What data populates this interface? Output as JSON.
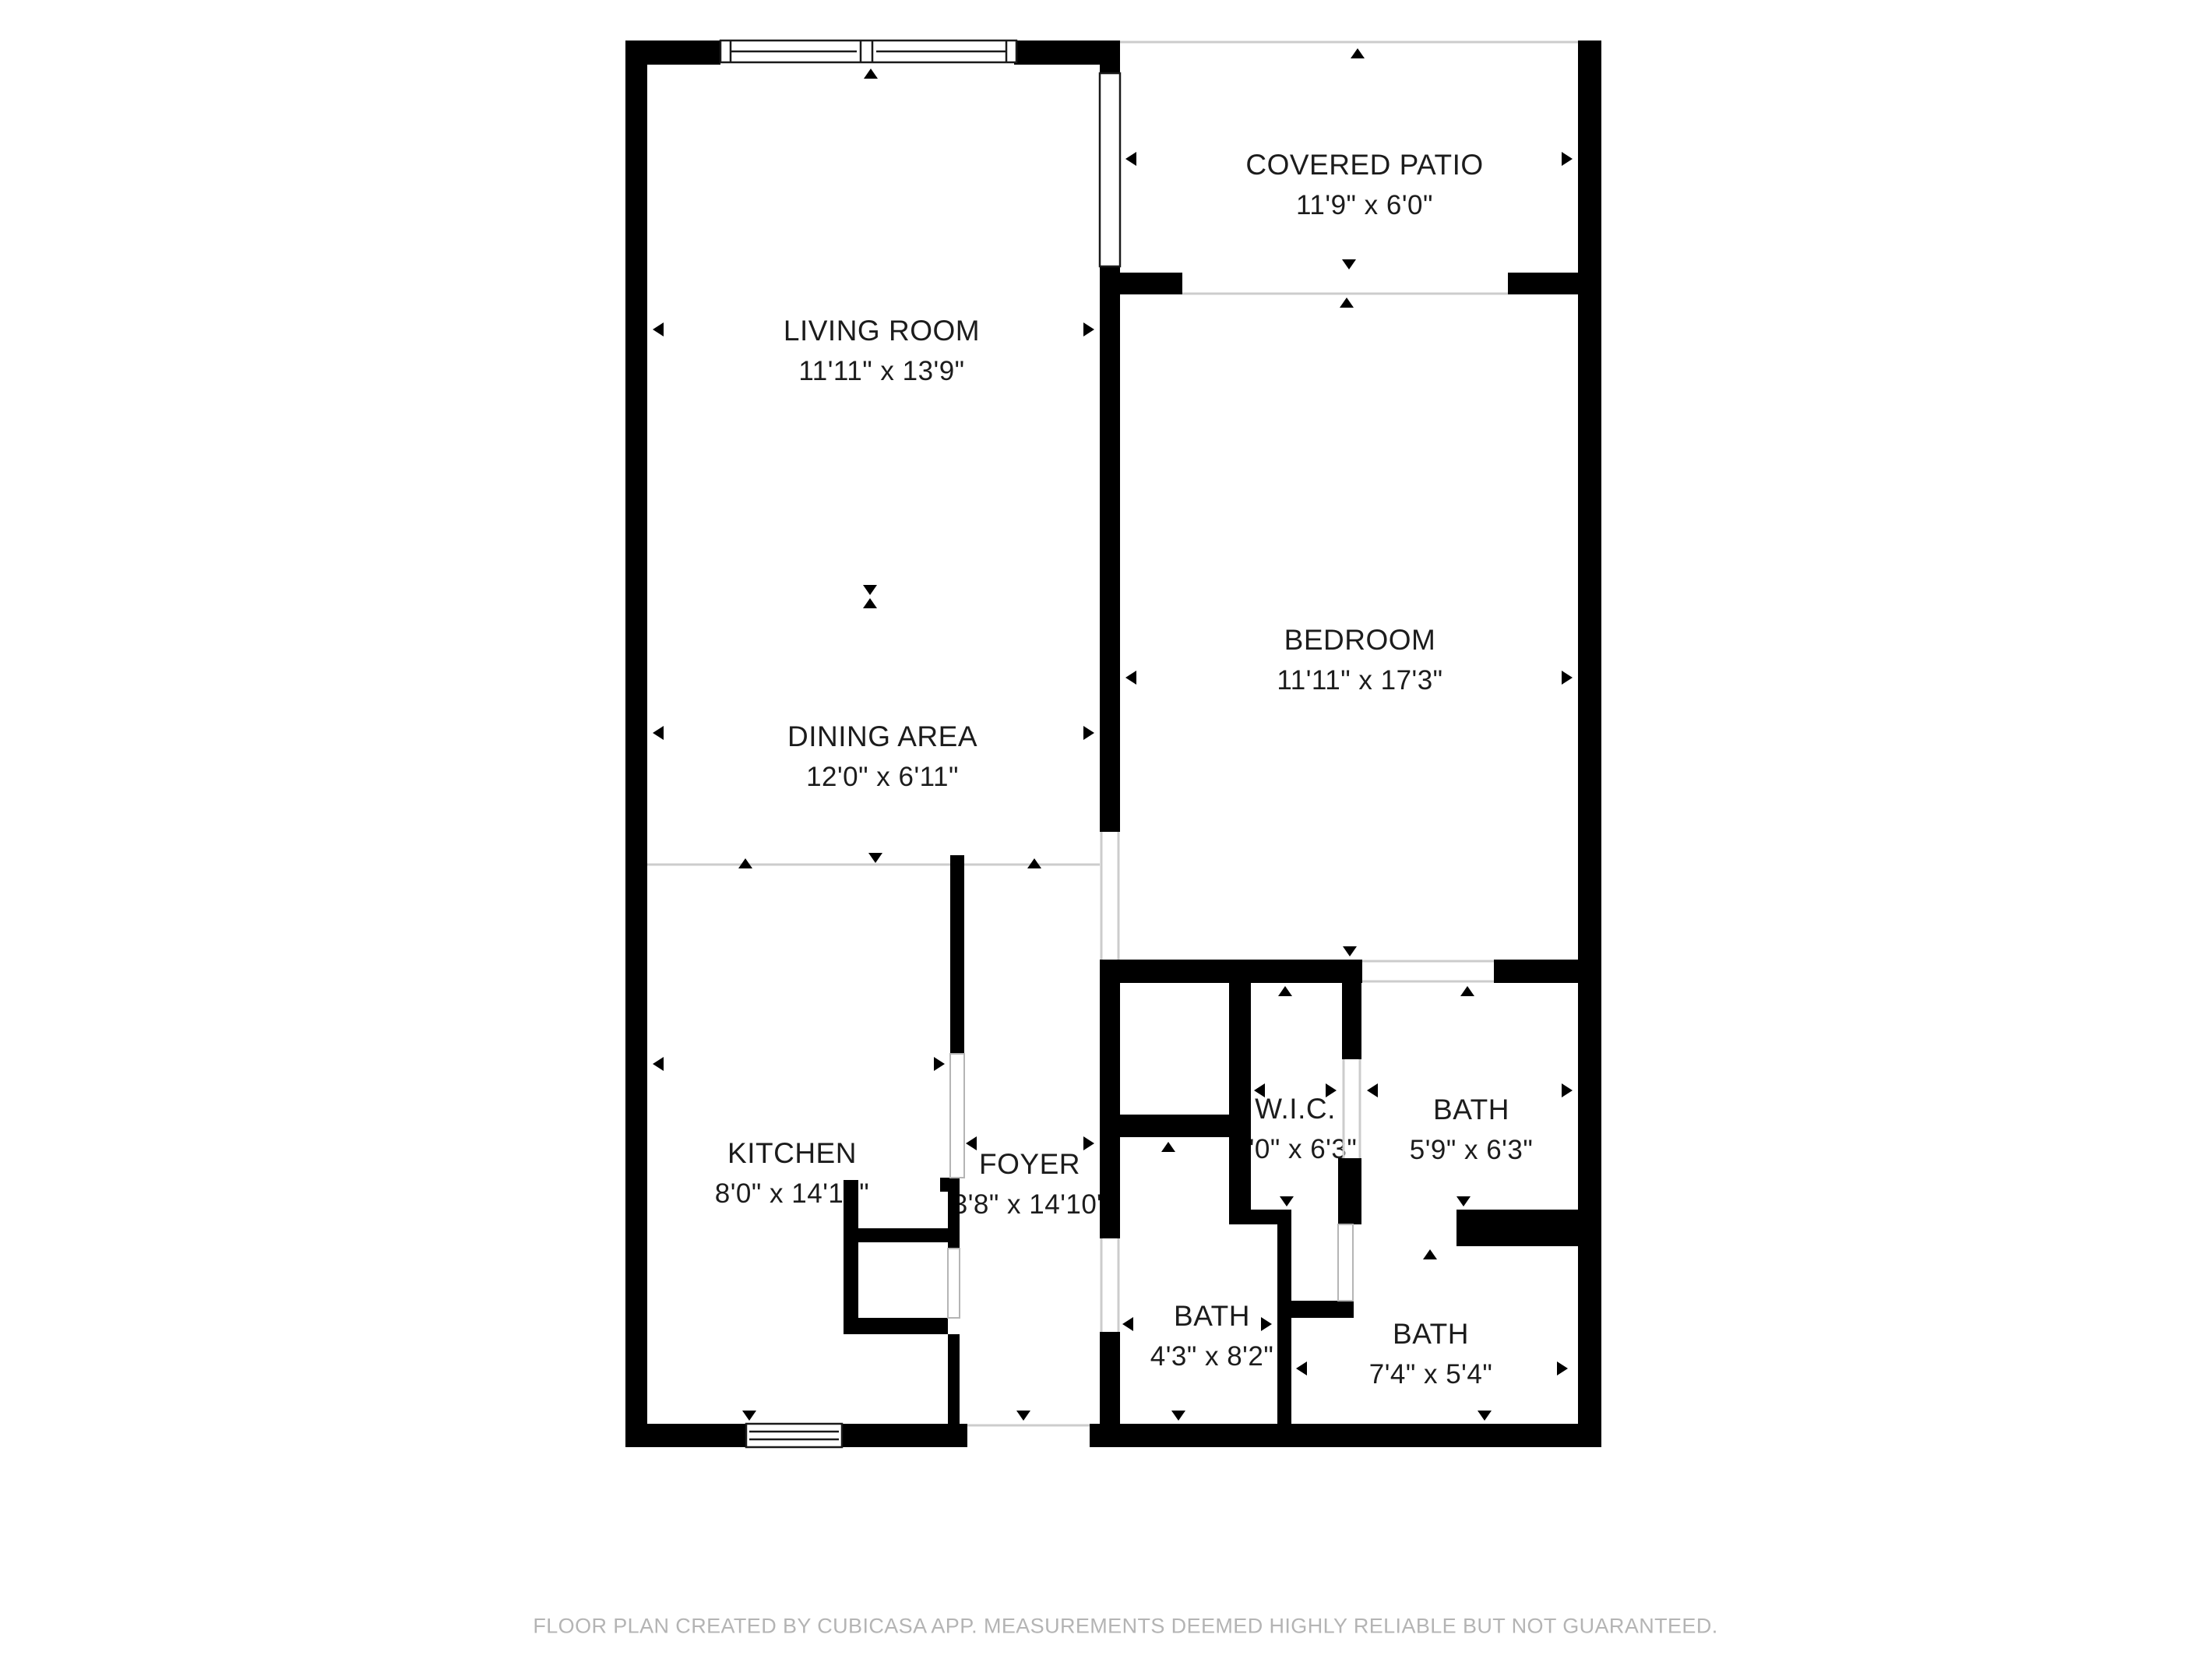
{
  "floor_plan": {
    "rooms": [
      {
        "id": "covered-patio",
        "name": "COVERED PATIO",
        "dimensions": "11'9\" x 6'0\""
      },
      {
        "id": "living-room",
        "name": "LIVING ROOM",
        "dimensions": "11'11\" x 13'9\""
      },
      {
        "id": "bedroom",
        "name": "BEDROOM",
        "dimensions": "11'11\" x 17'3\""
      },
      {
        "id": "dining-area",
        "name": "DINING AREA",
        "dimensions": "12'0\" x 6'11\""
      },
      {
        "id": "kitchen",
        "name": "KITCHEN",
        "dimensions": "8'0\" x 14'10\""
      },
      {
        "id": "foyer",
        "name": "FOYER",
        "dimensions": "3'8\" x 14'10\""
      },
      {
        "id": "walk-in-closet",
        "name": "W.I.C.",
        "dimensions": "3'0\" x 6'3\""
      },
      {
        "id": "bath-ensuite",
        "name": "BATH",
        "dimensions": "5'9\" x 6'3\""
      },
      {
        "id": "bath-hall",
        "name": "BATH",
        "dimensions": "4'3\" x 8'2\""
      },
      {
        "id": "bath-wc",
        "name": "BATH",
        "dimensions": "7'4\" x 5'4\""
      }
    ],
    "colors": {
      "wall": "#000000",
      "label_text": "#1c1c1c",
      "open_boundary_line": "#cccccc",
      "footer_text": "#b4b4b4",
      "background": "#ffffff"
    },
    "footer": "FLOOR PLAN CREATED BY CUBICASA APP. MEASUREMENTS DEEMED HIGHLY RELIABLE BUT NOT GUARANTEED."
  }
}
